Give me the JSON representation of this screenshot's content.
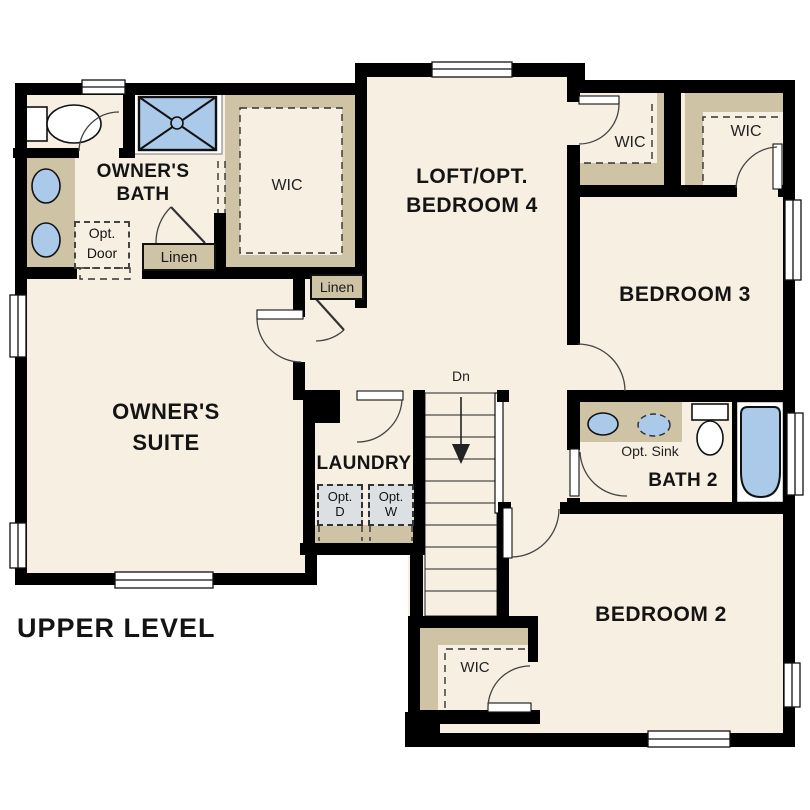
{
  "title": "UPPER LEVEL",
  "rooms": {
    "owners_suite": {
      "line1": "OWNER'S",
      "line2": "SUITE"
    },
    "owners_bath": {
      "line1": "OWNER'S",
      "line2": "BATH"
    },
    "loft": {
      "line1": "LOFT/OPT.",
      "line2": "BEDROOM 4"
    },
    "bedroom3": {
      "label": "BEDROOM 3"
    },
    "bedroom2": {
      "label": "BEDROOM 2"
    },
    "bath2": {
      "label": "BATH 2"
    },
    "laundry": {
      "label": "LAUNDRY"
    }
  },
  "closets": {
    "owners_wic": "WIC",
    "loft_wic": "WIC",
    "bedroom3_wic": "WIC",
    "bedroom2_wic": "WIC",
    "linen_bath": "Linen",
    "linen_hall": "Linen"
  },
  "annotations": {
    "opt_door": {
      "line1": "Opt.",
      "line2": "Door"
    },
    "opt_sink": "Opt. Sink",
    "opt_dryer": {
      "line1": "Opt.",
      "line2": "D"
    },
    "opt_washer": {
      "line1": "Opt.",
      "line2": "W"
    },
    "stairs_down": "Dn"
  },
  "palette": {
    "floor": "#f7efe2",
    "wall": "#000000",
    "shelving": "#cfc3a6",
    "fixture_blue": "#abc9e9",
    "appliance_gray": "#dde0e2",
    "line": "#333333"
  }
}
